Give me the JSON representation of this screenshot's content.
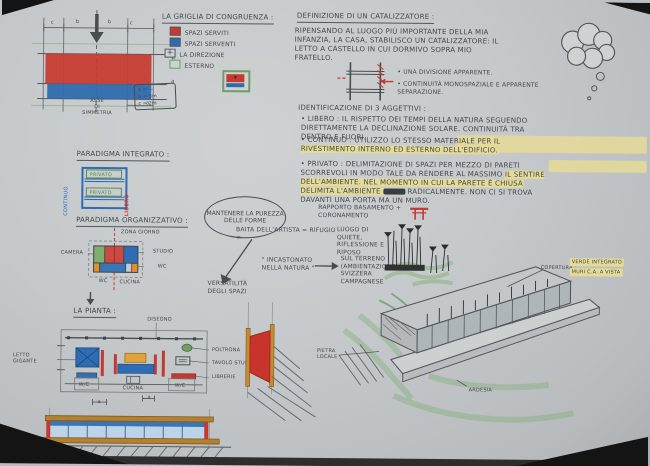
{
  "colors": {
    "paper": "#c8cbcd",
    "ink": "#45484d",
    "pencil": "#76797c",
    "red": "#c43a33",
    "blue": "#2e6cb3",
    "green": "#7fae6f",
    "orange": "#d98a2b",
    "yellow_highlight": "#e5db96"
  },
  "grid": {
    "axis_label": "ASSE\nDI\nSIMMETRIA",
    "dims_top": [
      "c",
      "b",
      "b",
      "c"
    ],
    "dim_right_top": "b",
    "dim_right_bottom": "a",
    "dim_bottom": "a"
  },
  "legend": {
    "title": "LA GRIGLIA DI CONGRUENZA :",
    "items": [
      {
        "label": "SPAZI SERVITI"
      },
      {
        "label": "SPAZI SERVENTI"
      },
      {
        "label": "LA DIREZIONE"
      },
      {
        "label": "ESTERNO"
      }
    ],
    "note_lines": [
      "a = —",
      "b = 3m",
      "c = 2m"
    ]
  },
  "catalyst": {
    "title": "DEFINIZIONE DI UN CATALIZZATORE :",
    "body": "RIPENSANDO AL LUOGO PIÙ IMPORTANTE DELLA MIA INFANZIA, LA CASA, STABILISCO UN CATALIZZATORE: IL LETTO A CASTELLO IN CUI DORMIVO SOPRA MIO FRATELLO.",
    "bullet1": "• UNA DIVISIONE APPARENTE.",
    "bullet2": "• CONTINUITÀ MONOSPAZIALE E APPARENTE SEPARAZIONE."
  },
  "adjectives": {
    "title": "IDENTIFICAZIONE DI 3 AGGETTIVI :",
    "libero_name": "• LIBERO :",
    "libero_text": "IL RISPETTO DEI TEMPI DELLA NATURA SEGUENDO DIRETTAMENTE LA DECLINAZIONE SOLARE. CONTINUITÀ TRA DENTRO E FUORI.",
    "continuo_name": "• CONTINUO :",
    "continuo_plain": "UTILIZZO LO STESSO MATERIALE ",
    "continuo_hl": "PER IL RIVESTIMENTO INTERNO ED ESTERNO DELL'EDIFICIO.",
    "privato_name": "• PRIVATO :",
    "privato_plain": "DELIMITAZIONE DI SPAZI PER MEZZO DI PARETI SCORREVOLI IN MODO TALE DA RENDERE AL MASSIMO ",
    "privato_hl": "IL SENTIRE DELL'AMBIENTE. NEL MOMENTO IN CUI LA PARETE È CHIUSA DELIMITA L'AMBIENTE ",
    "privato_tail": " RADICALMENTE. NON CI SI TROVA DAVANTI UNA PORTA MA UN MURO."
  },
  "paradigma_integrato": {
    "title": "PARADIGMA INTEGRATO :",
    "left": "CONTINUO",
    "top": "PRIVATO",
    "bottom": "PRIVATO",
    "right": "LIBERO"
  },
  "paradigma_organizzativo": {
    "title": "PARADIGMA ORGANIZZATIVO :",
    "zona_giorno": "ZONA GIORNO",
    "camera": "CAMERA",
    "studio": "STUDIO",
    "wc_right": "WC",
    "wc_bottom": "WC",
    "cucina": "CUCINA"
  },
  "center": {
    "bubble": "MANTENERE LA PUREZZA DELLE FORME",
    "rapporto": "RAPPORTO BASAMENTO + CORONAMENTO",
    "baita": "BAITA DELL'ARTISTA = RIFUGIO =",
    "luogo": "LUOGO DI QUIETE, RIFLESSIONE E RIPOSO",
    "incastonato": "\" INCASTONATO NELLA NATURA \"",
    "terreno": "SUL TERRENO (AMBIENTAZIONE) SVIZZERA CAMPAGNESE",
    "versatilita": "VERSATILITÀ DEGLI SPAZI"
  },
  "perspective": {
    "copertura": "COPERTURA :",
    "hl1": "VERDE INTEGRATO",
    "hl2": "MURI C.A. A VISTA",
    "pietra": "PIETRA\nLOCALE",
    "ardesia": "ARDESIA"
  },
  "pianta": {
    "title": "LA PIANTA :",
    "disegno": "DISEGNO",
    "letto": "LETTO\nGIGANTE",
    "poltrona": "POLTRONA",
    "tavolo": "TAVOLO STUDIO",
    "librerie": "LIBRERIE",
    "wc_left": "W/C",
    "cucina": "CUCINA",
    "wc_right": "W/C",
    "dim_a1": "a",
    "dim_a2": "a"
  }
}
